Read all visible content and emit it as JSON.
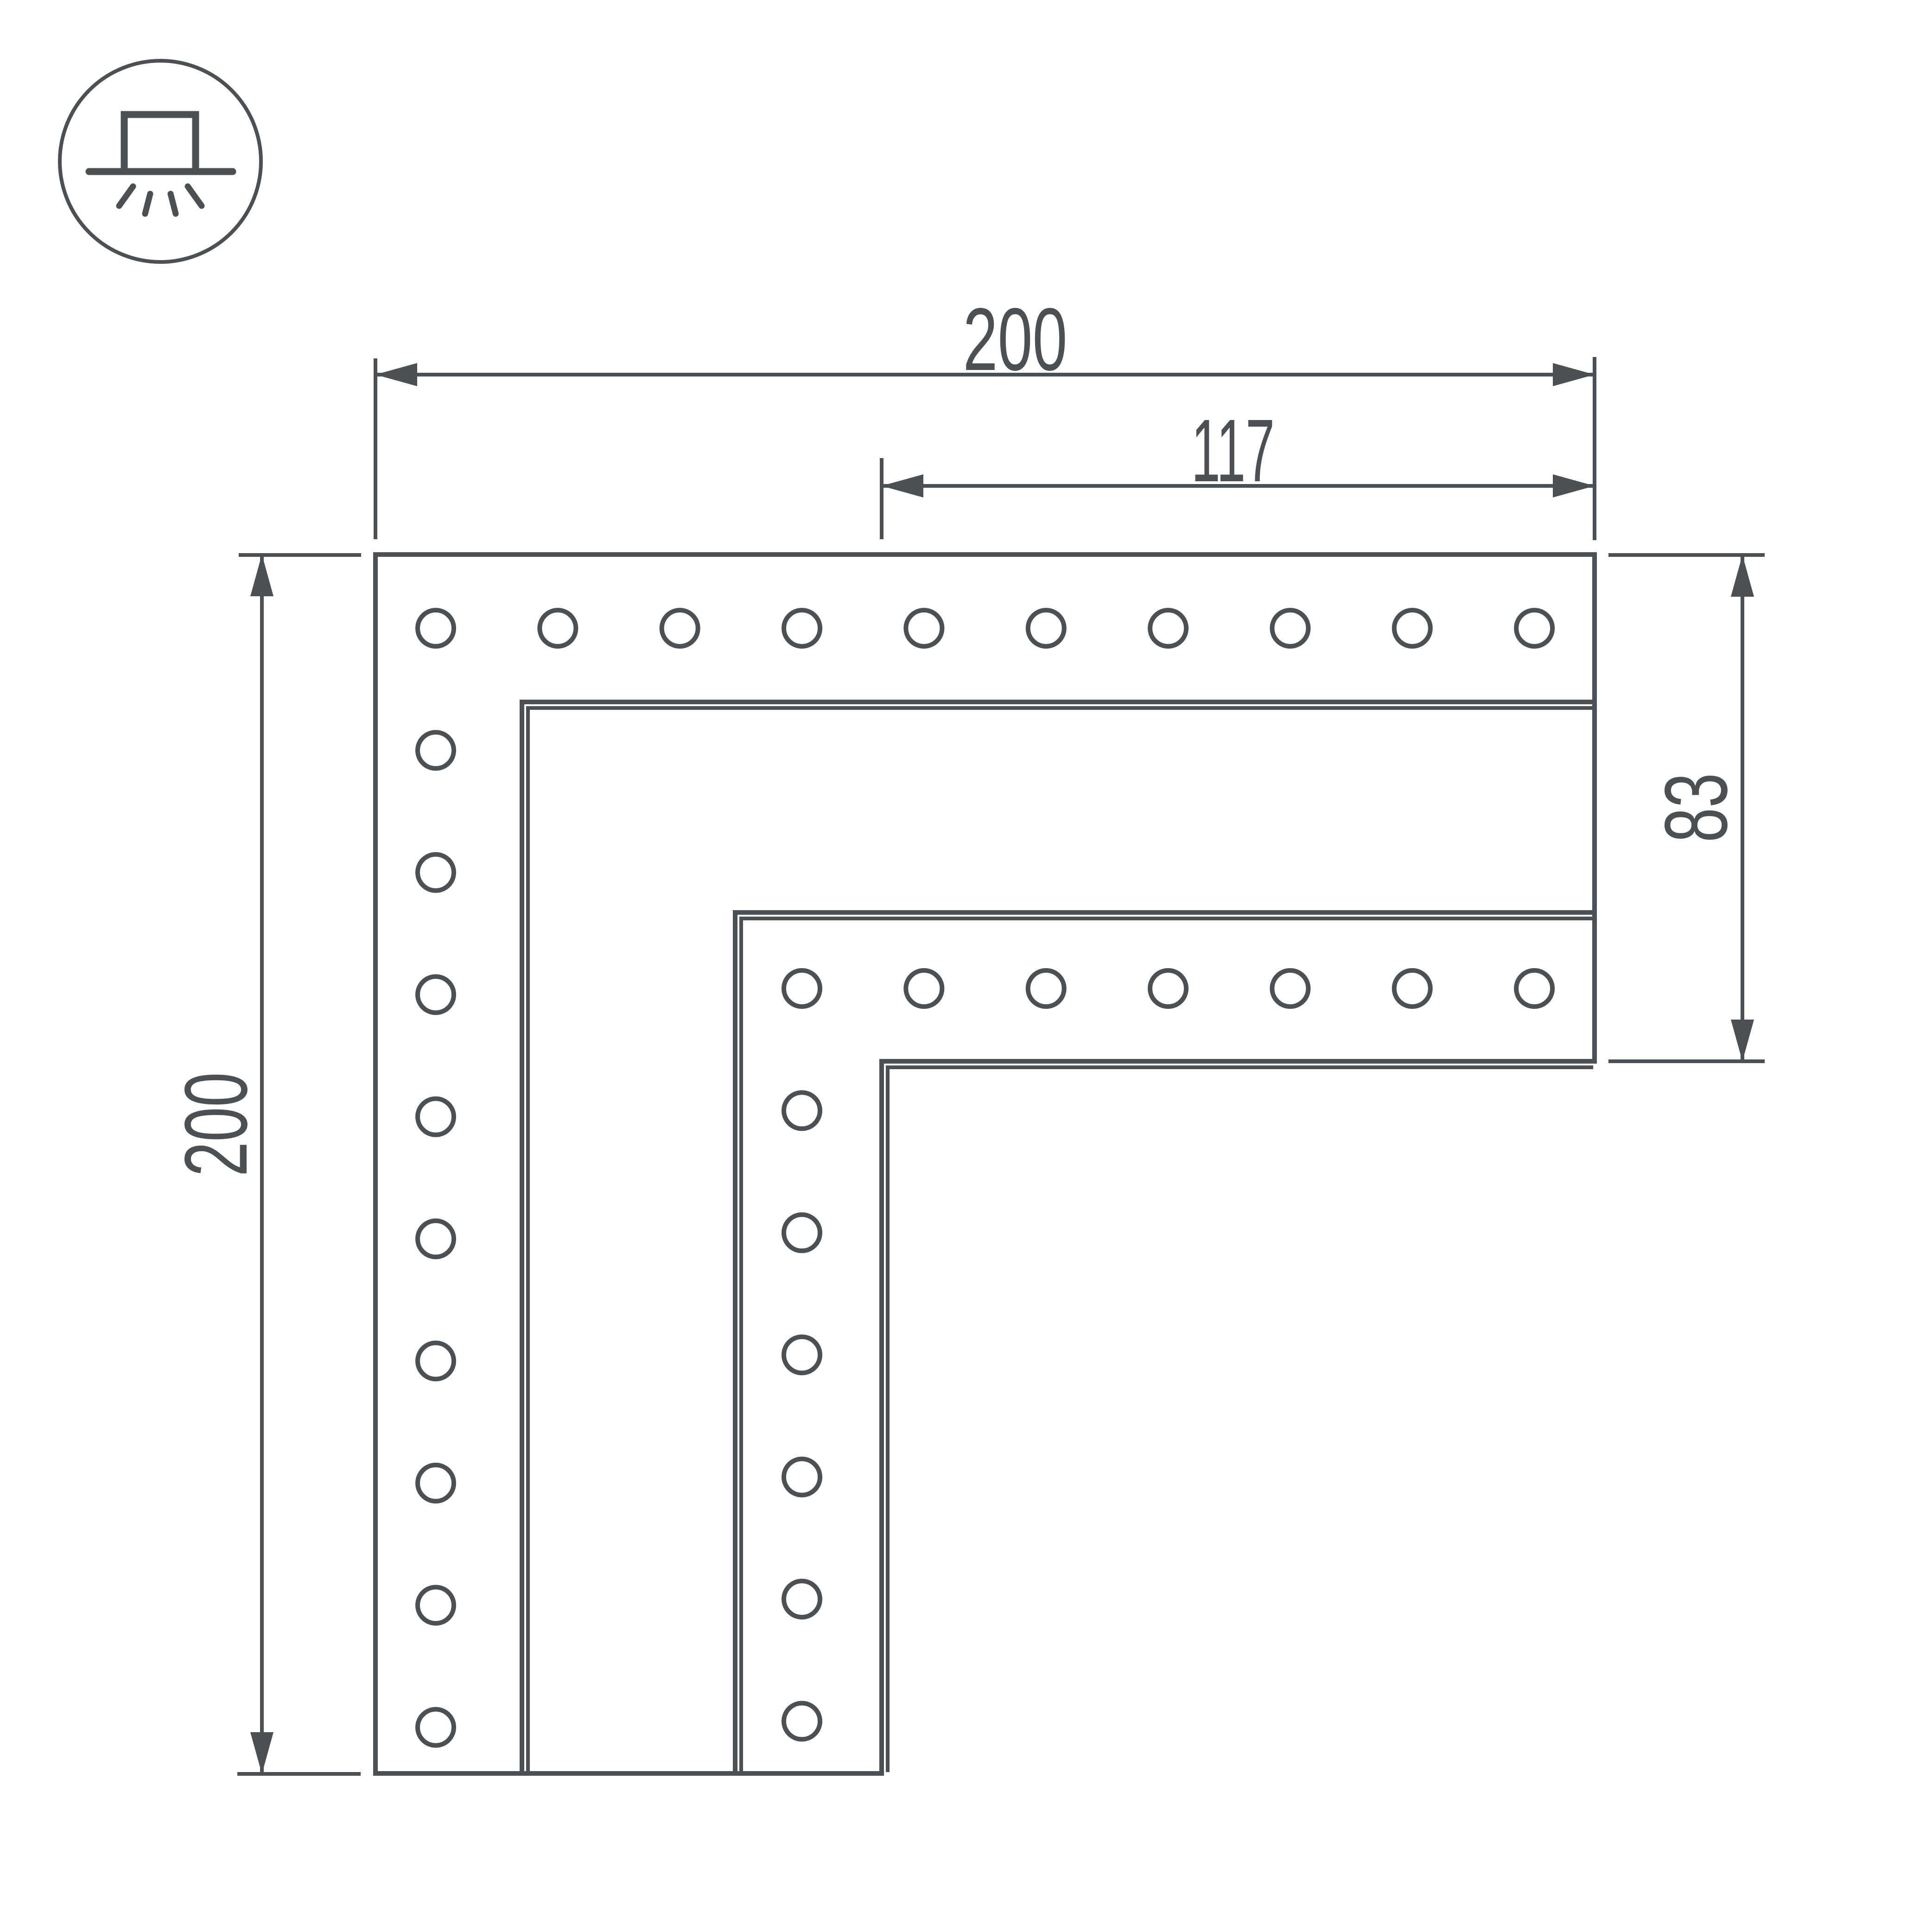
{
  "drawing": {
    "type": "dimension-drawing",
    "icon": "surface-mounted-downlight-icon",
    "colors": {
      "stroke": "#4a5054",
      "background": "#ffffff"
    },
    "dimensions": {
      "top_width": "200",
      "inner_width": "117",
      "left_height": "200",
      "right_height": "83"
    },
    "holes": {
      "top_row_count": 10,
      "left_column_count": 10,
      "inner_row_count": 7,
      "inner_column_count": 7
    }
  }
}
